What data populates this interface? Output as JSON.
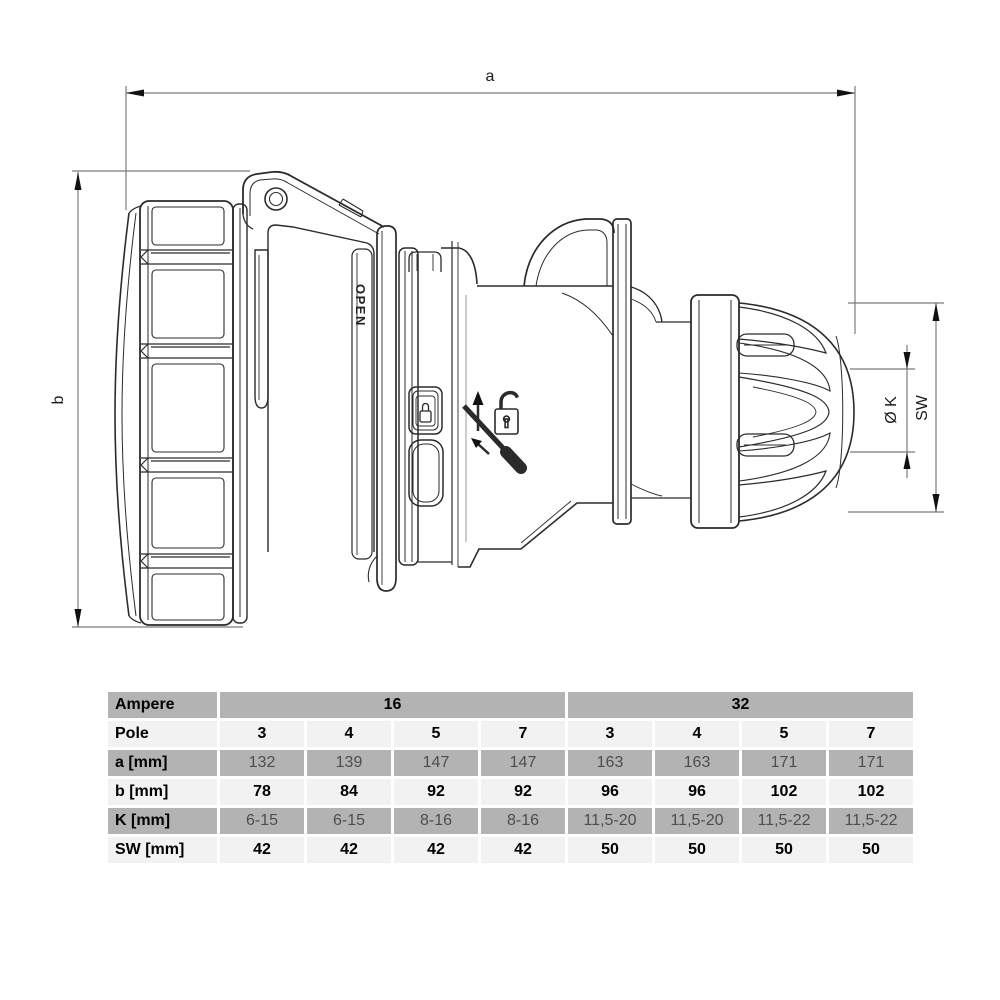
{
  "drawing": {
    "dimensions": {
      "a": "a",
      "b": "b",
      "k": "Ø K",
      "sw": "SW"
    },
    "open_label": "OPEN",
    "icons": {
      "slider": "padlock-icon",
      "instruction": [
        "up-arrow-icon",
        "open-padlock-icon",
        "screwdriver-icon",
        "diagonal-arrow-icon"
      ]
    },
    "colors": {
      "line": "#2b2b2b",
      "dim_line": "#7b7b7b",
      "label_text": "#1a1a1a"
    }
  },
  "table": {
    "colors": {
      "cell_gray": "#b3b3b3",
      "cell_light": "#f2f2f2",
      "muted_text": "#4d4d4d",
      "text": "#000000"
    },
    "rows": [
      {
        "label": "Ampere",
        "merged": [
          "16",
          "32"
        ]
      },
      {
        "label": "Pole",
        "values": [
          "3",
          "4",
          "5",
          "7",
          "3",
          "4",
          "5",
          "7"
        ]
      },
      {
        "label": "a [mm]",
        "values": [
          "132",
          "139",
          "147",
          "147",
          "163",
          "163",
          "171",
          "171"
        ]
      },
      {
        "label": "b [mm]",
        "values": [
          "78",
          "84",
          "92",
          "92",
          "96",
          "96",
          "102",
          "102"
        ]
      },
      {
        "label": "K [mm]",
        "values": [
          "6-15",
          "6-15",
          "8-16",
          "8-16",
          "11,5-20",
          "11,5-20",
          "11,5-22",
          "11,5-22"
        ]
      },
      {
        "label": "SW [mm]",
        "values": [
          "42",
          "42",
          "42",
          "42",
          "50",
          "50",
          "50",
          "50"
        ]
      }
    ]
  }
}
